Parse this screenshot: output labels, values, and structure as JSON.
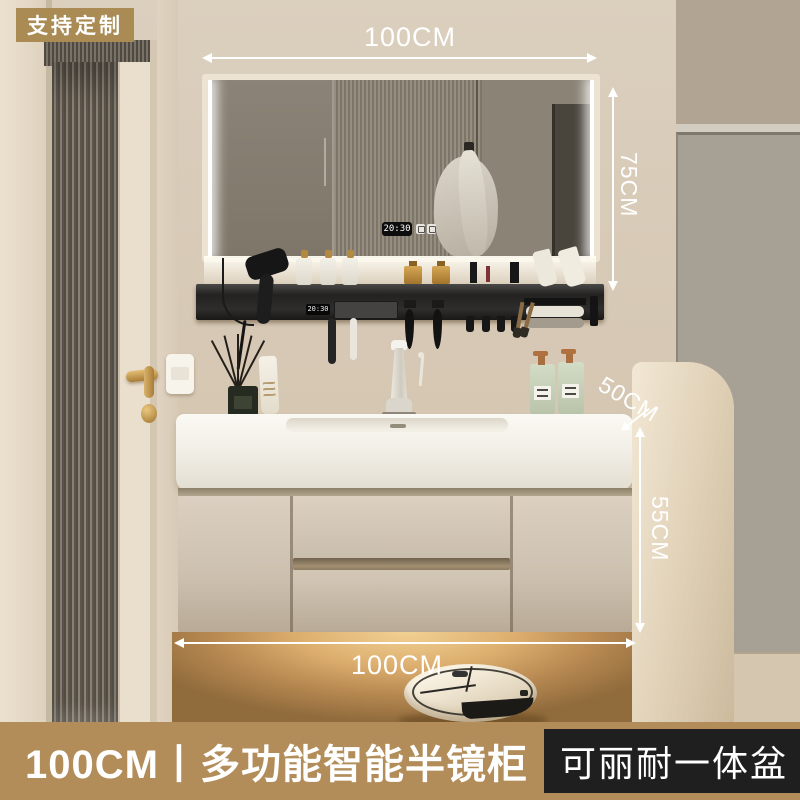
{
  "badge": {
    "label": "支持定制"
  },
  "dimensions": {
    "top_width": "100CM",
    "mirror_height": "75CM",
    "counter_depth": "50CM",
    "cabinet_height": "55CM",
    "bottom_width": "100CM"
  },
  "mirror": {
    "clock_time": "20:30"
  },
  "shelf": {
    "clock_time": "20:30"
  },
  "footer": {
    "title": "100CM丨多功能智能半镜柜",
    "highlight": "可丽耐一体盆"
  },
  "colors": {
    "accent_tan": "#b28d5a",
    "badge_tan": "#a98b53",
    "highlight_box": "#1f1f1f",
    "annotation_white": "#ffffff",
    "wall_cream": "#d6c9b6",
    "grey_panel": "#a7a094",
    "rail_black": "#232221",
    "cabinet_greige": "#cfc2b0",
    "counter_white": "#f5f2ea",
    "floor_glow": "#f1d193",
    "soap_green": "#c9d3bb",
    "robot_cream": "#ece1cb"
  }
}
